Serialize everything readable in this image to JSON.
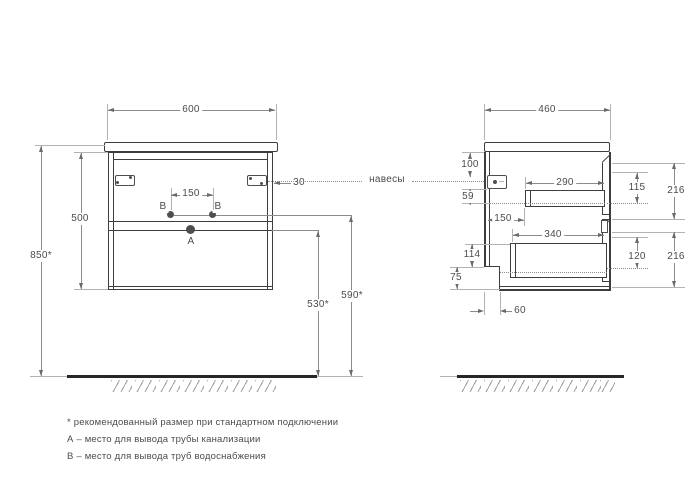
{
  "front_view": {
    "width": "600",
    "height": "500",
    "mount_height": "850*",
    "outlet_spacing": "150",
    "hinge_offset": "30",
    "hangers_label": "навесы",
    "water_point_left": "B",
    "water_point_right": "B",
    "drain_point": "A",
    "water_outlet_height": "590*",
    "drain_outlet_height": "530*"
  },
  "side_view": {
    "depth": "460",
    "hanger_top_offset": "100",
    "hanger_drop": "59",
    "back_clearance": "150",
    "top_drawer_depth": "290",
    "top_drawer_inner_height": "115",
    "top_front_height": "216",
    "bottom_drawer_depth": "340",
    "bottom_drawer_inner_height": "120",
    "bottom_front_height": "216",
    "bottom_clearance": "114",
    "plinth_height": "75",
    "plinth_depth": "60"
  },
  "footnotes": [
    "* рекомендованный размер при стандартном подключении",
    "А – место для вывода трубы канализации",
    "В – место для вывода труб водоснабжения"
  ],
  "colors": {
    "outline": "#3d3d3d",
    "dimension_line": "#8c8c8c",
    "text": "#4c4c4c",
    "floor": "#262626",
    "hatch": "#9c9c9c",
    "background": "#ffffff"
  }
}
